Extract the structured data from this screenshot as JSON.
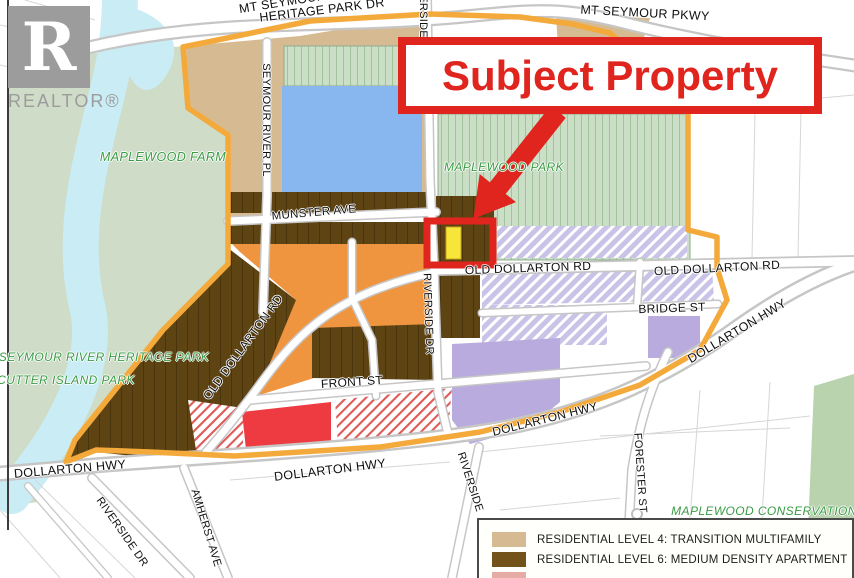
{
  "branding": {
    "logo_letter": "R",
    "logo_wordmark": "REALTOR®"
  },
  "callout": {
    "subject_property": "Subject Property"
  },
  "legend": {
    "rows": [
      {
        "swatch": "#d6bb92",
        "label": "RESIDENTIAL LEVEL 4: TRANSITION MULTIFAMILY"
      },
      {
        "swatch": "#74531a",
        "label": "RESIDENTIAL LEVEL 6: MEDIUM DENSITY APARTMENT"
      },
      {
        "swatch": "#e4aca4",
        "label": ""
      }
    ]
  },
  "map_labels": [
    {
      "name": "mt-seymour-pkwy",
      "text": "MT SEYMOUR PKWY",
      "x": 645,
      "y": 13,
      "rot": 3,
      "size": 12.5,
      "cls": "street"
    },
    {
      "name": "mt-seymour-pkwy-west",
      "text": "MT SEYMOUR PKWY",
      "x": 303,
      "y": -1,
      "rot": -9,
      "size": 12.5,
      "cls": "street"
    },
    {
      "name": "heritage-park-dr",
      "text": "HERITAGE PARK DR",
      "x": 322,
      "y": 10,
      "rot": -7,
      "size": 12.5,
      "cls": "street"
    },
    {
      "name": "seymour-river-pl",
      "text": "SEYMOUR RIVER PL",
      "x": 266,
      "y": 120,
      "rot": 90,
      "size": 11,
      "cls": "street"
    },
    {
      "name": "munster-ave",
      "text": "MUNSTER AVE",
      "x": 314,
      "y": 213,
      "rot": -5,
      "size": 11.5,
      "cls": "street"
    },
    {
      "name": "riverside-top",
      "text": "RIVERSIDE",
      "x": 423,
      "y": 7,
      "rot": 90,
      "size": 11,
      "cls": "street"
    },
    {
      "name": "riverside-dr-mid",
      "text": "RIVERSIDE DR",
      "x": 428,
      "y": 314,
      "rot": 88,
      "size": 11,
      "cls": "street"
    },
    {
      "name": "old-dollarton-rd-center",
      "text": "OLD DOLLARTON RD",
      "x": 528,
      "y": 268,
      "rot": -2,
      "size": 12,
      "cls": "street"
    },
    {
      "name": "old-dollarton-rd-east",
      "text": "OLD DOLLARTON RD",
      "x": 717,
      "y": 268,
      "rot": -3,
      "size": 12,
      "cls": "street"
    },
    {
      "name": "old-dollarton-rd-diag",
      "text": "OLD DOLLARTON RD",
      "x": 243,
      "y": 347,
      "rot": -54,
      "size": 12,
      "cls": "street"
    },
    {
      "name": "bridge-st",
      "text": "BRIDGE ST",
      "x": 672,
      "y": 308,
      "rot": -2,
      "size": 12,
      "cls": "street"
    },
    {
      "name": "front-st",
      "text": "FRONT ST",
      "x": 352,
      "y": 382,
      "rot": -4,
      "size": 12,
      "cls": "street"
    },
    {
      "name": "dollarton-hwy-west",
      "text": "DOLLARTON HWY",
      "x": 70,
      "y": 469,
      "rot": -5,
      "size": 12.5,
      "cls": "street"
    },
    {
      "name": "dollarton-hwy-center",
      "text": "DOLLARTON HWY",
      "x": 330,
      "y": 470,
      "rot": -7,
      "size": 12.5,
      "cls": "street"
    },
    {
      "name": "dollarton-hwy-mid",
      "text": "DOLLARTON HWY",
      "x": 545,
      "y": 419,
      "rot": -14,
      "size": 12,
      "cls": "street"
    },
    {
      "name": "dollarton-hwy-east",
      "text": "DOLLARTON HWY",
      "x": 737,
      "y": 331,
      "rot": -31,
      "size": 12.5,
      "cls": "street"
    },
    {
      "name": "amherst-ave",
      "text": "AMHERST AVE",
      "x": 206,
      "y": 528,
      "rot": 73,
      "size": 11,
      "cls": "street"
    },
    {
      "name": "riverside-dr-south",
      "text": "RIVERSIDE DR",
      "x": 122,
      "y": 532,
      "rot": 55,
      "size": 11,
      "cls": "street"
    },
    {
      "name": "riverside-south",
      "text": "RIVERSIDE",
      "x": 470,
      "y": 482,
      "rot": 72,
      "size": 11,
      "cls": "street"
    },
    {
      "name": "forester-st",
      "text": "FORESTER ST",
      "x": 640,
      "y": 473,
      "rot": 86,
      "size": 11,
      "cls": "street"
    },
    {
      "name": "maplewood-farm",
      "text": "MAPLEWOOD FARM",
      "x": 163,
      "y": 157,
      "rot": 0,
      "size": 12.5,
      "cls": "park"
    },
    {
      "name": "maplewood-park",
      "text": "MAPLEWOOD PARK",
      "x": 504,
      "y": 167,
      "rot": 0,
      "size": 12,
      "cls": "park"
    },
    {
      "name": "seymour-river-heritage-park",
      "text": "SEYMOUR RIVER HERITAGE PARK",
      "x": 104,
      "y": 357,
      "rot": 0,
      "size": 12,
      "cls": "park"
    },
    {
      "name": "cutter-island-park",
      "text": "CUTTER ISLAND PARK",
      "x": 66,
      "y": 380,
      "rot": 0,
      "size": 12,
      "cls": "park"
    },
    {
      "name": "maplewood-conservation",
      "text": "MAPLEWOOD CONSERVATION",
      "x": 764,
      "y": 511,
      "rot": 0,
      "size": 12,
      "cls": "park"
    }
  ],
  "colors": {
    "subject_red": "#e0241e",
    "subject_yellow": "#f6e63a",
    "boundary_orange": "#f4a93b",
    "zone_tan": "#d6bb92",
    "zone_brown": "#5e4313",
    "zone_orange": "#f0953f",
    "zone_blue": "#87b7ee",
    "zone_lavender": "#b9abde",
    "zone_lavender_hatch": "#c9c3e8",
    "zone_green_parcel": "#cbdfc6",
    "zone_red": "#ee3b41",
    "park_green": "#cfdcc8",
    "conservation_green": "#b9d3ae",
    "river_blue": "#c9ecf5",
    "park_label_green": "#3a9b44",
    "road_casing": "#c6c6c6",
    "logo_gray": "#9c9c9c"
  }
}
